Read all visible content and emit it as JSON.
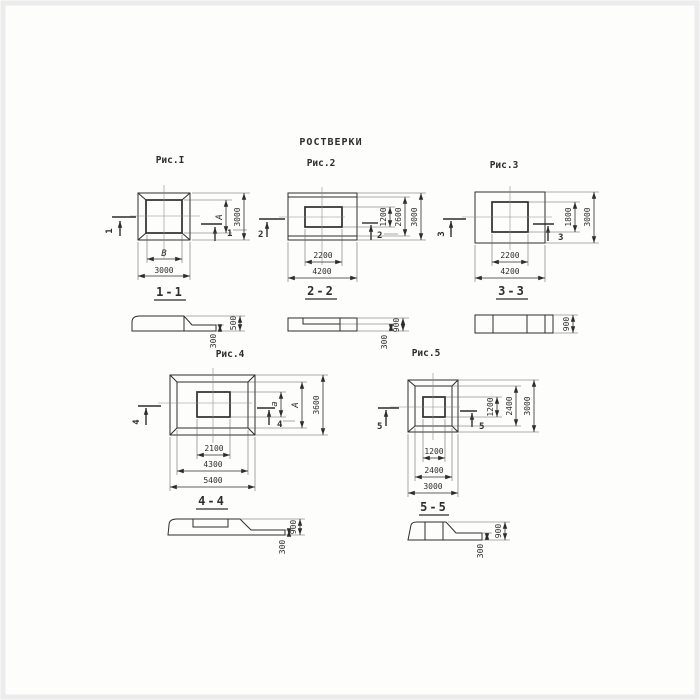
{
  "page": {
    "title": "РОСТВЕРКИ"
  },
  "figures": {
    "fig1": {
      "caption": "Рис.I",
      "cut_label": "1",
      "plan": {
        "width_inner": "В",
        "width_outer": "3000",
        "height_inner": "А",
        "height_outer": "3000"
      },
      "section": {
        "label": "1-1",
        "dim_total": "500",
        "dim_step": "300"
      }
    },
    "fig2": {
      "caption": "Рис.2",
      "cut_label": "2",
      "plan": {
        "width_inner": "2200",
        "width_outer": "4200",
        "height_inner": "1200",
        "height_mid": "2600",
        "height_outer": "3000"
      },
      "section": {
        "label": "2-2",
        "dim_total": "900",
        "dim_step": "300"
      }
    },
    "fig3": {
      "caption": "Рис.3",
      "cut_label": "3",
      "plan": {
        "width_inner": "2200",
        "width_outer": "4200",
        "height_inner": "1800",
        "height_outer": "3000"
      },
      "section": {
        "label": "3-3",
        "dim_total": "900"
      }
    },
    "fig4": {
      "caption": "Рис.4",
      "cut_label": "4",
      "plan": {
        "width_inner": "2100",
        "width_mid": "4300",
        "width_outer": "5400",
        "height_inner": "а",
        "height_mid": "А",
        "height_outer": "3600"
      },
      "section": {
        "label": "4-4",
        "dim_total": "900",
        "dim_step": "300"
      }
    },
    "fig5": {
      "caption": "Рис.5",
      "cut_label": "5",
      "plan": {
        "width_inner": "1200",
        "width_mid": "2400",
        "width_outer": "3000",
        "height_inner": "1200",
        "height_mid": "2400",
        "height_outer": "3000"
      },
      "section": {
        "label": "5-5",
        "dim_total": "900",
        "dim_step": "300"
      }
    }
  }
}
